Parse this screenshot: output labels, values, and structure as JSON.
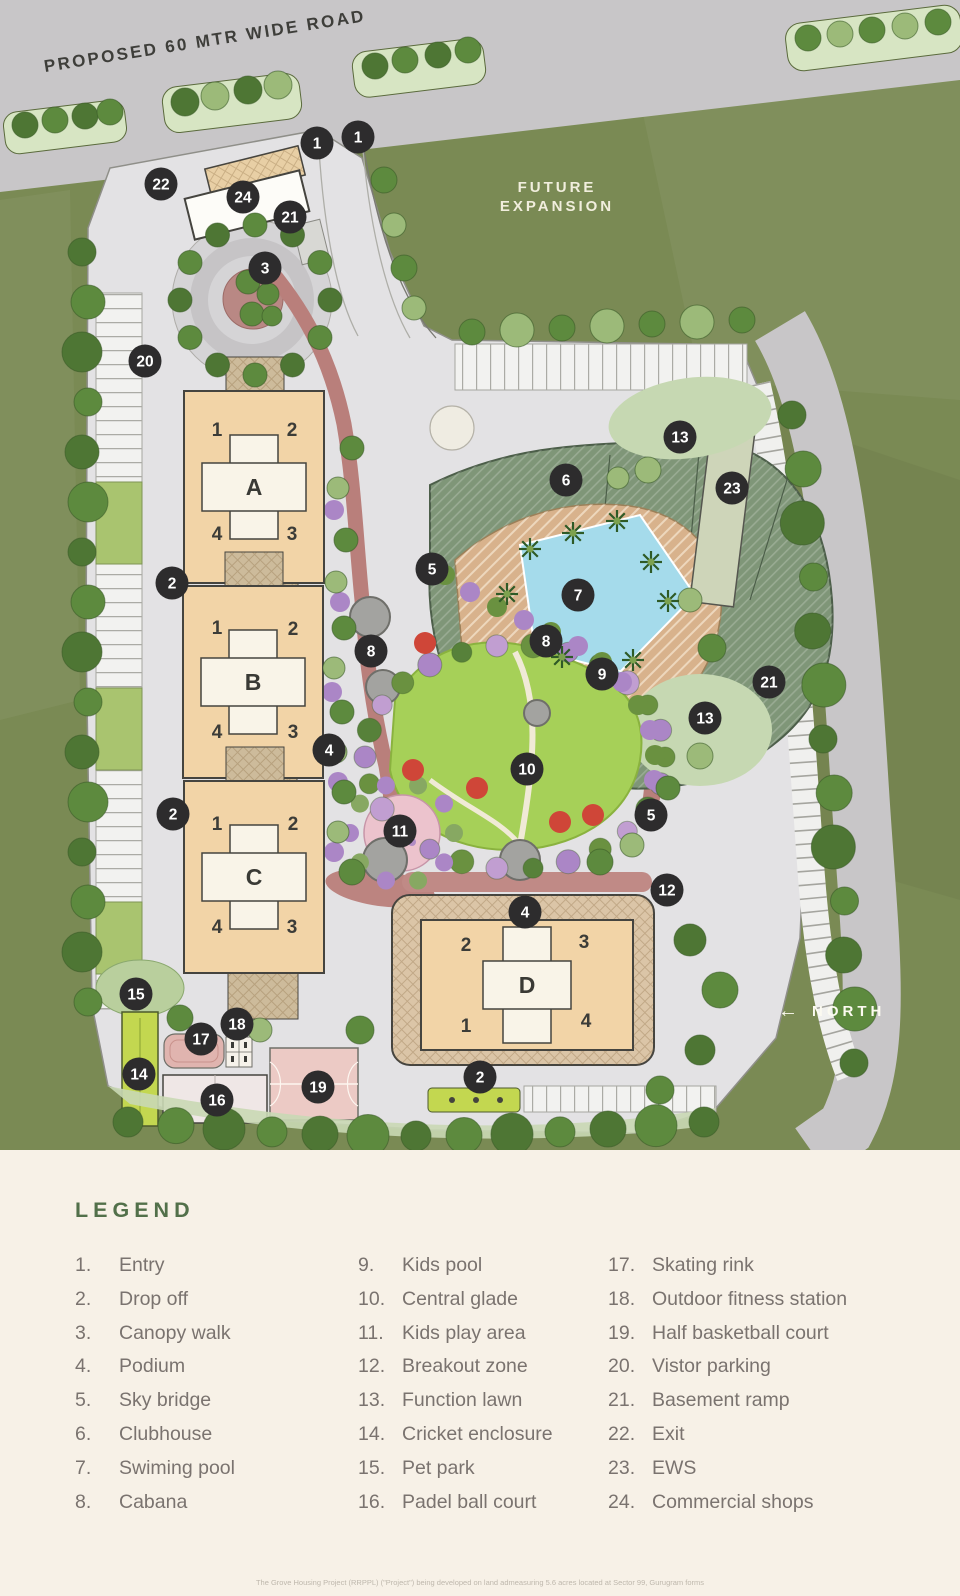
{
  "plan": {
    "labels": {
      "road": "PROPOSED 60 MTR WIDE ROAD",
      "future_1": "FUTURE",
      "future_2": "EXPANSION",
      "north_arrow": "←",
      "north": "NORTH"
    },
    "towers": [
      {
        "letter": "A",
        "cx": 254,
        "cy": 487,
        "w": 140,
        "h": 192,
        "units": [
          {
            "n": "1",
            "x": 217,
            "y": 429
          },
          {
            "n": "2",
            "x": 292,
            "y": 429
          },
          {
            "n": "4",
            "x": 217,
            "y": 533
          },
          {
            "n": "3",
            "x": 292,
            "y": 533
          }
        ]
      },
      {
        "letter": "B",
        "cx": 253,
        "cy": 682,
        "w": 140,
        "h": 192,
        "units": [
          {
            "n": "1",
            "x": 217,
            "y": 627
          },
          {
            "n": "2",
            "x": 293,
            "y": 628
          },
          {
            "n": "4",
            "x": 217,
            "y": 731
          },
          {
            "n": "3",
            "x": 293,
            "y": 731
          }
        ]
      },
      {
        "letter": "C",
        "cx": 254,
        "cy": 877,
        "w": 140,
        "h": 192,
        "units": [
          {
            "n": "1",
            "x": 217,
            "y": 823
          },
          {
            "n": "2",
            "x": 293,
            "y": 823
          },
          {
            "n": "4",
            "x": 217,
            "y": 926
          },
          {
            "n": "3",
            "x": 292,
            "y": 926
          }
        ]
      },
      {
        "letter": "D",
        "cx": 527,
        "cy": 985,
        "w": 212,
        "h": 130,
        "units": [
          {
            "n": "2",
            "x": 466,
            "y": 944
          },
          {
            "n": "3",
            "x": 584,
            "y": 941
          },
          {
            "n": "1",
            "x": 466,
            "y": 1025
          },
          {
            "n": "4",
            "x": 586,
            "y": 1020
          }
        ]
      }
    ],
    "markers": [
      {
        "n": "1",
        "x": 317,
        "y": 143
      },
      {
        "n": "1",
        "x": 358,
        "y": 137
      },
      {
        "n": "22",
        "x": 161,
        "y": 184
      },
      {
        "n": "24",
        "x": 243,
        "y": 197
      },
      {
        "n": "21",
        "x": 290,
        "y": 217
      },
      {
        "n": "3",
        "x": 265,
        "y": 268
      },
      {
        "n": "20",
        "x": 145,
        "y": 361
      },
      {
        "n": "13",
        "x": 680,
        "y": 437
      },
      {
        "n": "6",
        "x": 566,
        "y": 480
      },
      {
        "n": "23",
        "x": 732,
        "y": 488
      },
      {
        "n": "5",
        "x": 432,
        "y": 569
      },
      {
        "n": "2",
        "x": 172,
        "y": 583
      },
      {
        "n": "7",
        "x": 578,
        "y": 595
      },
      {
        "n": "8",
        "x": 546,
        "y": 641
      },
      {
        "n": "8",
        "x": 371,
        "y": 651
      },
      {
        "n": "9",
        "x": 602,
        "y": 674
      },
      {
        "n": "21",
        "x": 769,
        "y": 682
      },
      {
        "n": "13",
        "x": 705,
        "y": 718
      },
      {
        "n": "4",
        "x": 329,
        "y": 750
      },
      {
        "n": "10",
        "x": 527,
        "y": 769
      },
      {
        "n": "2",
        "x": 173,
        "y": 814
      },
      {
        "n": "5",
        "x": 651,
        "y": 815
      },
      {
        "n": "11",
        "x": 400,
        "y": 831
      },
      {
        "n": "12",
        "x": 667,
        "y": 890
      },
      {
        "n": "4",
        "x": 525,
        "y": 912
      },
      {
        "n": "15",
        "x": 136,
        "y": 994
      },
      {
        "n": "18",
        "x": 237,
        "y": 1024
      },
      {
        "n": "17",
        "x": 201,
        "y": 1039
      },
      {
        "n": "14",
        "x": 139,
        "y": 1074
      },
      {
        "n": "2",
        "x": 480,
        "y": 1077
      },
      {
        "n": "19",
        "x": 318,
        "y": 1087
      },
      {
        "n": "16",
        "x": 217,
        "y": 1100
      }
    ]
  },
  "legend": {
    "title": "LEGEND",
    "columns": [
      {
        "items": [
          {
            "num": "1.",
            "label": "Entry"
          },
          {
            "num": "2.",
            "label": "Drop off"
          },
          {
            "num": "3.",
            "label": "Canopy walk"
          },
          {
            "num": "4.",
            "label": "Podium"
          },
          {
            "num": "5.",
            "label": "Sky bridge"
          },
          {
            "num": "6.",
            "label": "Clubhouse"
          },
          {
            "num": "7.",
            "label": "Swiming pool"
          },
          {
            "num": "8.",
            "label": "Cabana"
          }
        ]
      },
      {
        "items": [
          {
            "num": "9.",
            "label": "Kids pool"
          },
          {
            "num": "10.",
            "label": "Central glade"
          },
          {
            "num": "11.",
            "label": "Kids play area"
          },
          {
            "num": "12.",
            "label": "Breakout zone"
          },
          {
            "num": "13.",
            "label": "Function lawn"
          },
          {
            "num": "14.",
            "label": "Cricket enclosure"
          },
          {
            "num": "15.",
            "label": "Pet park"
          },
          {
            "num": "16.",
            "label": "Padel ball court"
          }
        ]
      },
      {
        "items": [
          {
            "num": "17.",
            "label": "Skating rink"
          },
          {
            "num": "18.",
            "label": "Outdoor fitness station"
          },
          {
            "num": "19.",
            "label": "Half basketball court"
          },
          {
            "num": "20.",
            "label": "Vistor parking"
          },
          {
            "num": "21.",
            "label": "Basement ramp"
          },
          {
            "num": "22.",
            "label": "Exit"
          },
          {
            "num": "23.",
            "label": "EWS"
          },
          {
            "num": "24.",
            "label": "Commercial shops"
          }
        ]
      }
    ]
  },
  "footnote": "The Grove Housing Project (RRPPL) (\"Project\") being developed on land admeasuring 5.6 acres located at Sector 99, Gurugram forms",
  "colors": {
    "site_green": "#7a8a54",
    "road_gray": "#c8c6c8",
    "site_gray": "#e3e2e4",
    "building_tan": "#f2d4a7",
    "core_white": "#f9f4e8",
    "clubhouse_green": "#7f9678",
    "pool_blue": "#a5dbeb",
    "brick_path": "#b97f7b",
    "glade_green": "#a6d058",
    "marker_dark": "#2d2c2d",
    "legend_bg": "#f7f1e7",
    "legend_green": "#52704a",
    "legend_text": "#7a736f"
  }
}
